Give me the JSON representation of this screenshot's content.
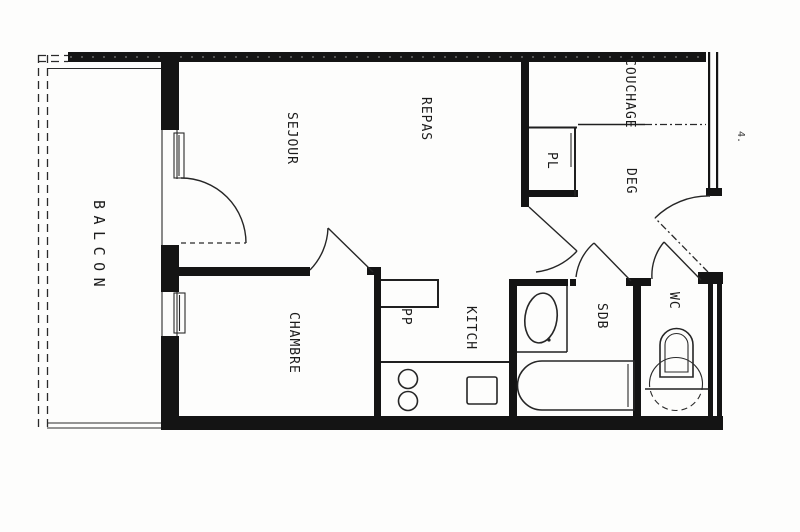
{
  "document": {
    "kind": "scanned apartment floor plan"
  },
  "rooms": {
    "balcon": {
      "label": "BALCON"
    },
    "sejour": {
      "label": "SEJOUR"
    },
    "repas": {
      "label": "REPAS"
    },
    "couchage": {
      "label": "COUCHAGE"
    },
    "pl": {
      "label": "PL"
    },
    "deg": {
      "label": "DEG"
    },
    "chambre": {
      "label": "CHAMBRE"
    },
    "pp": {
      "label": "PP"
    },
    "kitch": {
      "label": "KITCH"
    },
    "sdb": {
      "label": "SDB"
    },
    "wc": {
      "label": "WC"
    }
  },
  "annotations": {
    "page_mark": "4."
  },
  "colors": {
    "ink": "#141414",
    "paper": "#fdfdfc"
  }
}
